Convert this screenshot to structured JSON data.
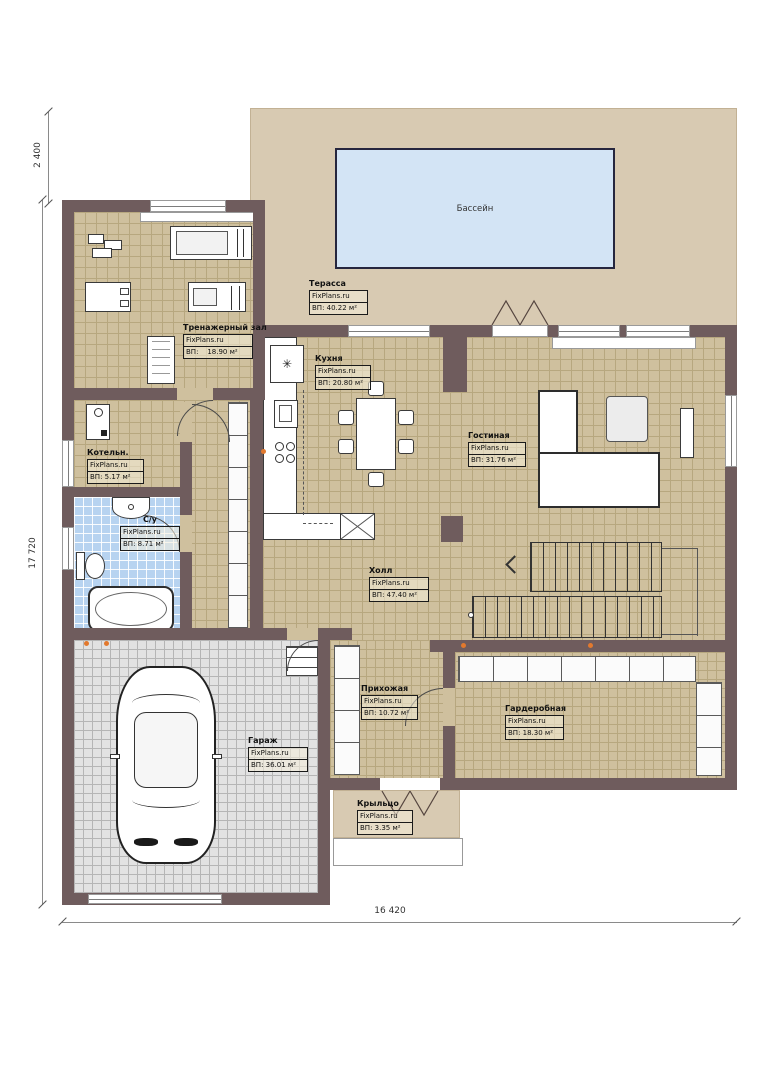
{
  "plan": {
    "brand": "FixPlans.ru",
    "pool": {
      "label": "Бассейн"
    },
    "dimensions": {
      "terrace_height": "2 400",
      "house_height": "17 720",
      "house_width": "16 420"
    },
    "rooms": [
      {
        "name": "Терасса",
        "area": "ВП: 40.22 м²"
      },
      {
        "name": "Тренажерный зал",
        "area": "ВП:    18.90 м²"
      },
      {
        "name": "Кухня",
        "area": "ВП: 20.80 м²"
      },
      {
        "name": "Гостиная",
        "area": "ВП: 31.76 м²"
      },
      {
        "name": "Котельн.",
        "area": "ВП: 5.17 м²"
      },
      {
        "name": "С/у",
        "area": "ВП: 8.71 м²"
      },
      {
        "name": "Холл",
        "area": "ВП: 47.40 м²"
      },
      {
        "name": "Прихожая",
        "area": "ВП: 10.72 м²"
      },
      {
        "name": "Гардеробная",
        "area": "ВП: 18.30 м²"
      },
      {
        "name": "Гараж",
        "area": "ВП: 36.01 м²"
      },
      {
        "name": "Крыльцо",
        "area": "ВП: 3.35 м²"
      }
    ],
    "icons": {
      "fridge_snowflake": "✳"
    },
    "colors": {
      "wall": "#6f5c5d",
      "floor": "#cfc09e",
      "terrace": "#d8cab2",
      "pool": "#d3e4f5",
      "bath_tile": "#b7d3f0",
      "garage_floor": "#e2e2e2",
      "accent_dot": "#e2792e"
    }
  }
}
